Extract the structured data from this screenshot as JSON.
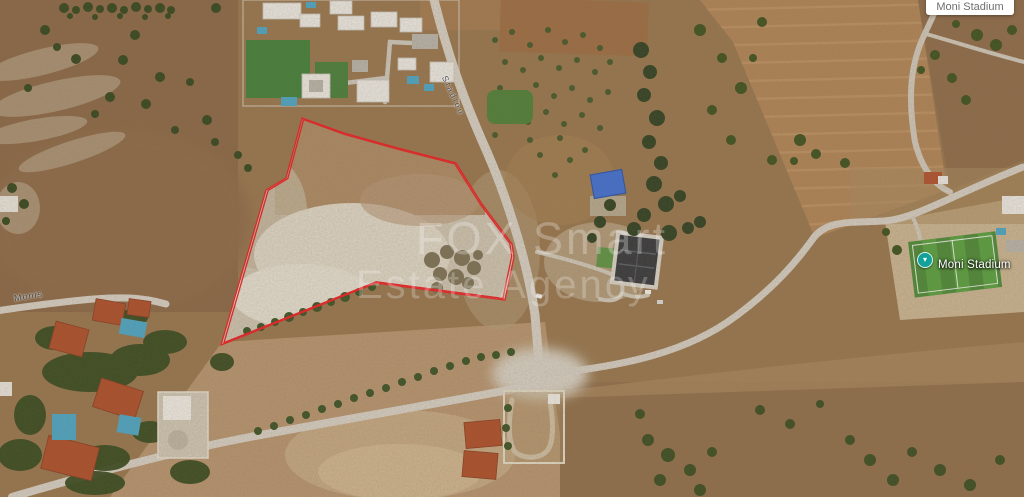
{
  "watermark": {
    "line1": "FOX Smart",
    "line2": "Estate Agency"
  },
  "road_labels": {
    "left": "Monis",
    "main": "Stadiou"
  },
  "poi": {
    "stadium": "Moni Stadium"
  },
  "info_box": {
    "text": "Moni Stadium"
  },
  "plot_outline": {
    "color": "#d92b2b",
    "stroke_width": 1.3,
    "points": [
      [
        302,
        118
      ],
      [
        344,
        133
      ],
      [
        398,
        148
      ],
      [
        456,
        163
      ],
      [
        482,
        204
      ],
      [
        512,
        244
      ],
      [
        514,
        257
      ],
      [
        505,
        300
      ],
      [
        376,
        283
      ],
      [
        221,
        345
      ],
      [
        266,
        190
      ],
      [
        286,
        178
      ]
    ]
  },
  "colors": {
    "plot_boundary": "#d92b2b",
    "poi_marker": "#12a29a",
    "stadium_green": "#4b8a38",
    "pool_blue": "#4aa6c7",
    "terrain": "#97764f",
    "road": "#d6d0c6"
  }
}
